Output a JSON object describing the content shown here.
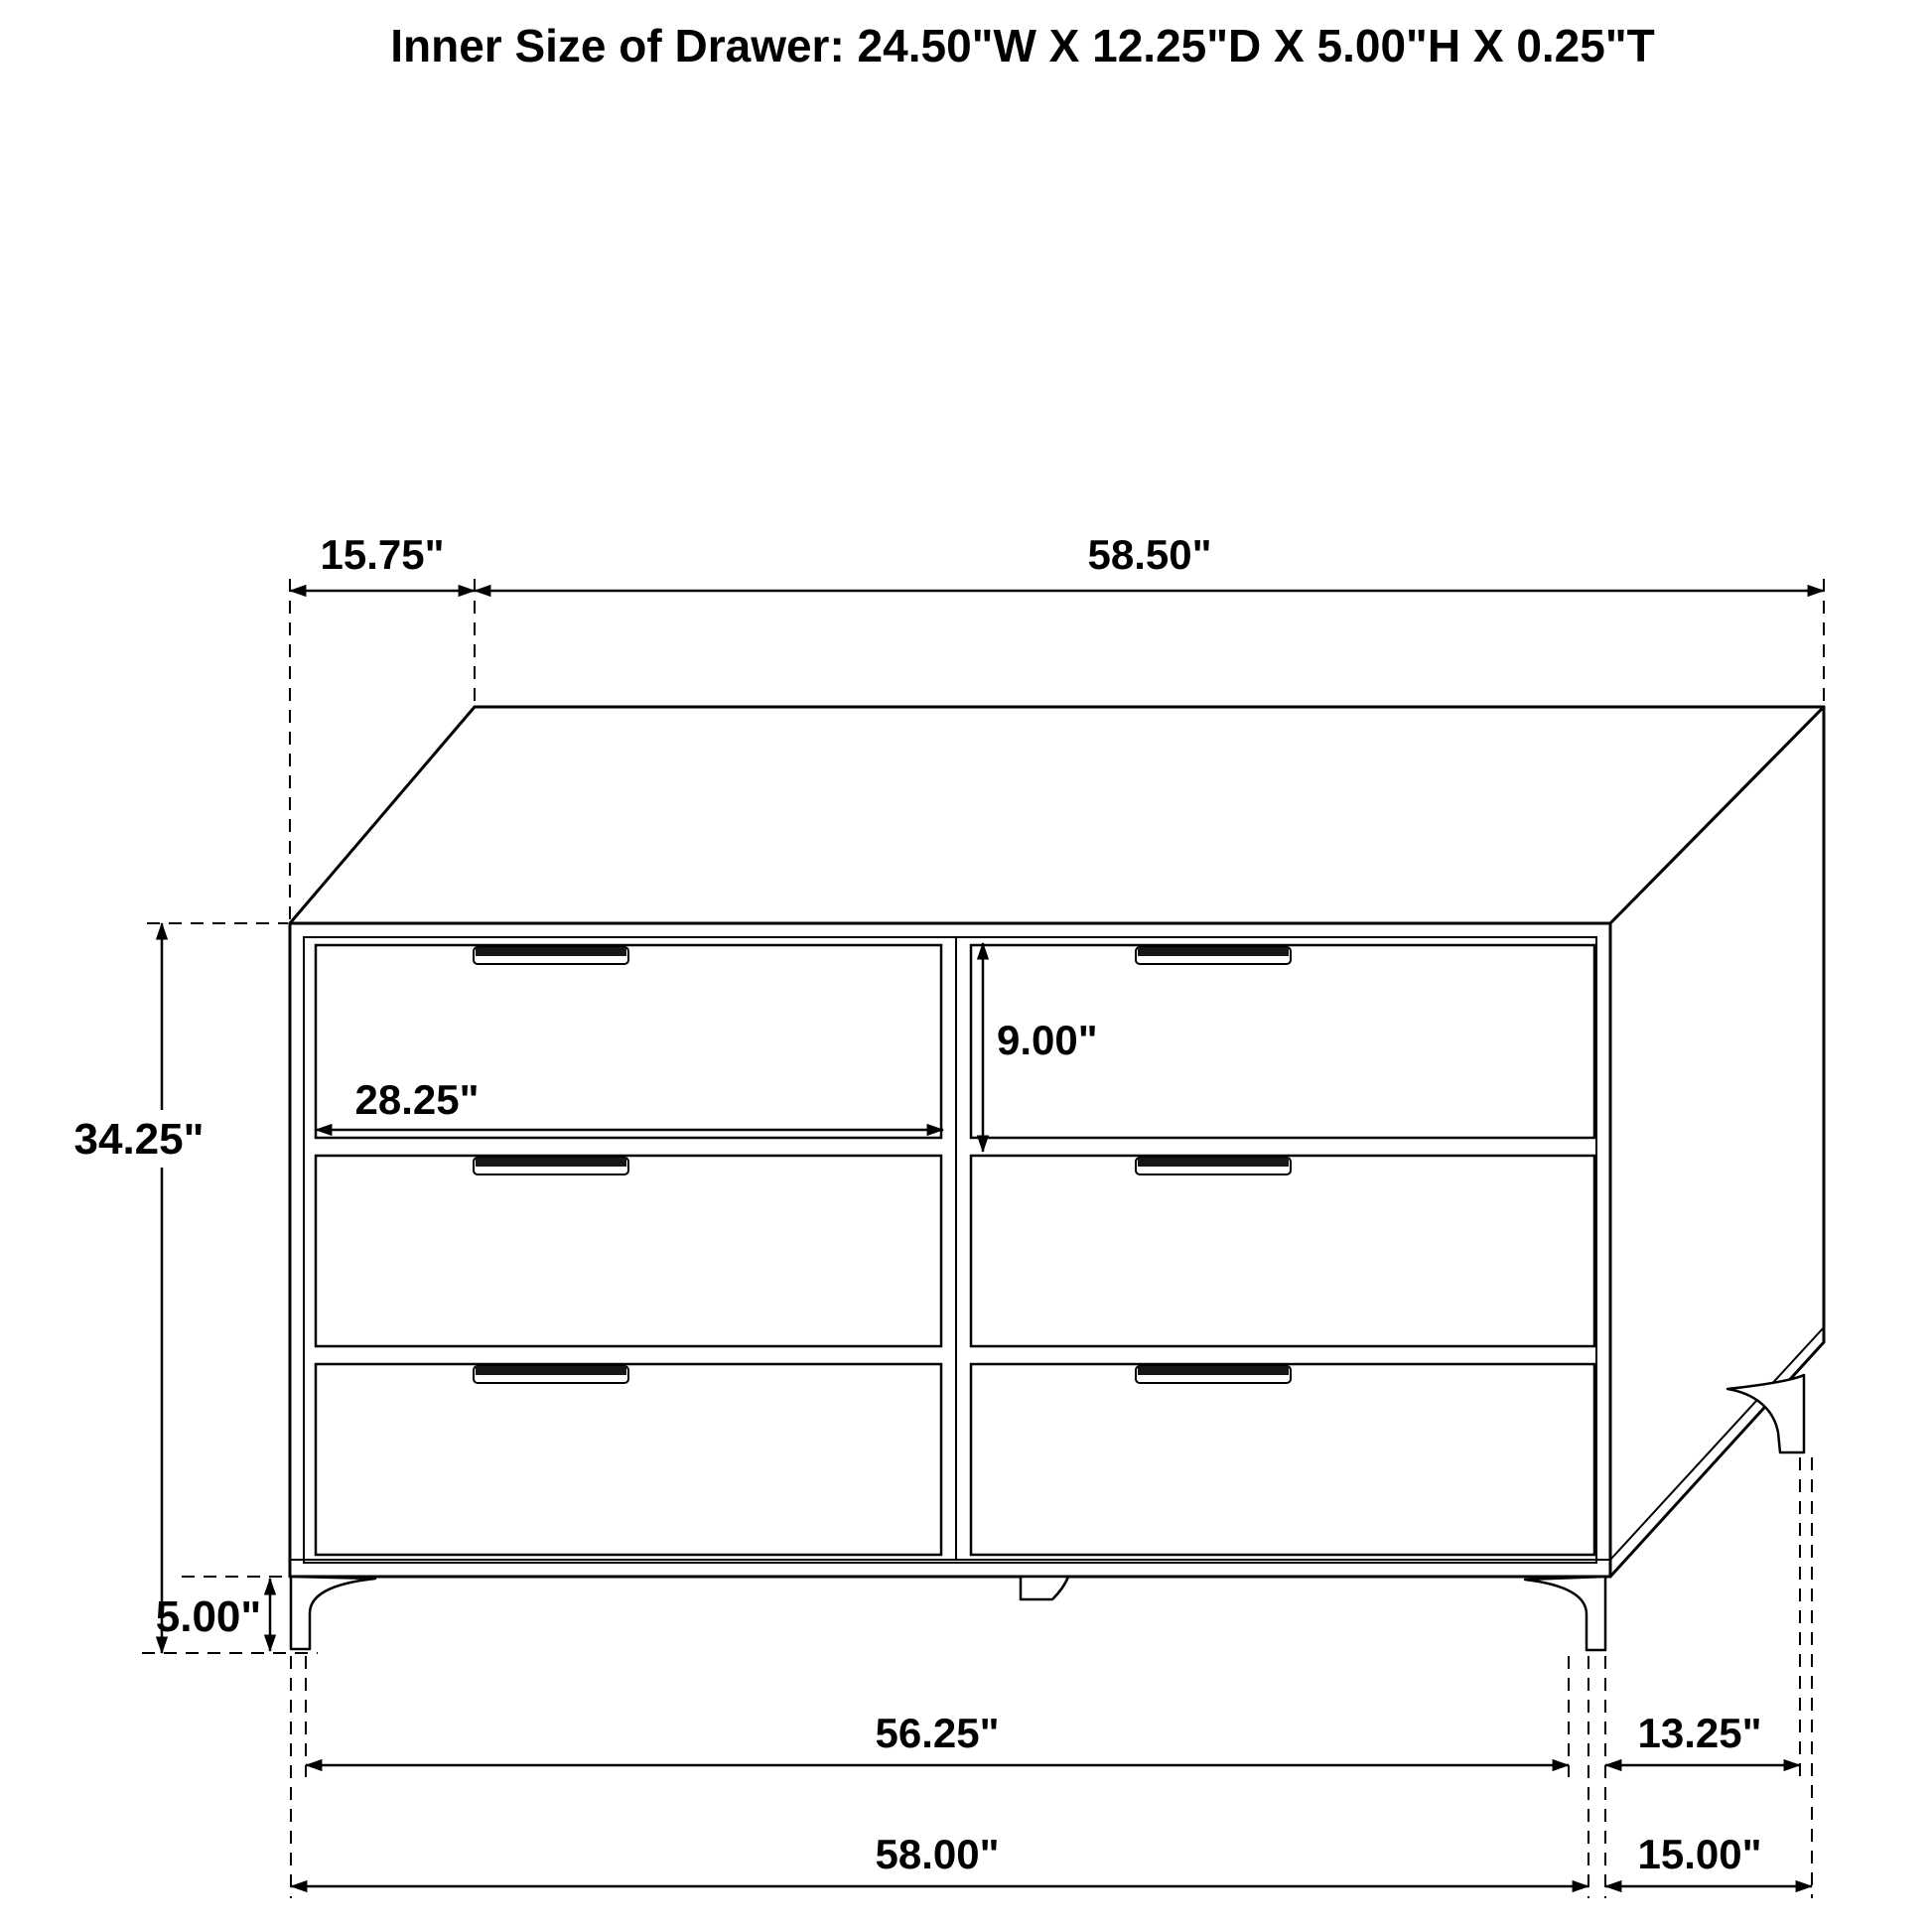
{
  "title": "Inner Size of Drawer: 24.50\"W X 12.25\"D X 5.00\"H X 0.25\"T",
  "dimension_labels": {
    "top_depth": "15.75\"",
    "top_width": "58.50\"",
    "overall_height": "34.25\"",
    "leg_height": "5.00\"",
    "drawer_width": "28.25\"",
    "drawer_front_height": "9.00\"",
    "front_leg_span": "56.25\"",
    "leg_depth_span": "13.25\"",
    "overall_width": "58.00\"",
    "overall_depth": "15.00\""
  },
  "drawing": {
    "subject": "six-drawer dresser",
    "view": "three-quarter technical line drawing",
    "drawer_count": "6",
    "line_color": "#000000",
    "background_color": "#ffffff"
  }
}
